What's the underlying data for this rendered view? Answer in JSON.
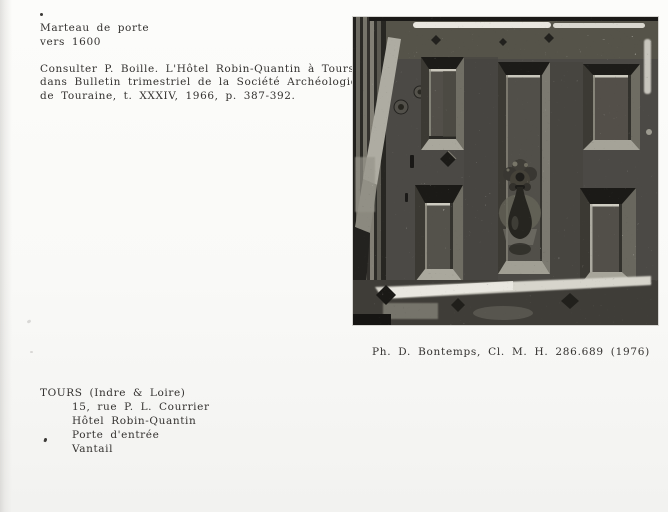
{
  "document": {
    "object_title": "Marteau de porte",
    "object_date": "vers 1600",
    "reference_lines": [
      "Consulter P. Boille. L'Hôtel Robin-Quantin à Tours,",
      "dans Bulletin trimestriel de la Société Archéologique",
      "de Touraine, t. XXXIV, 1966, p. 387-392."
    ],
    "photo_caption": "Ph. D. Bontemps, Cl. M. H. 286.689 (1976)",
    "location_heading": "TOURS (Indre & Loire)",
    "location_lines": [
      "15, rue P. L. Courrier",
      "Hôtel Robin-Quantin",
      "Porte d'entrée",
      "Vantail"
    ]
  },
  "colors": {
    "paper": "#f9f9f7",
    "ink": "#343230",
    "photo_shadow": "#1a1917",
    "photo_midtone": "#4b4945",
    "photo_highlight": "#e9e7e0"
  }
}
